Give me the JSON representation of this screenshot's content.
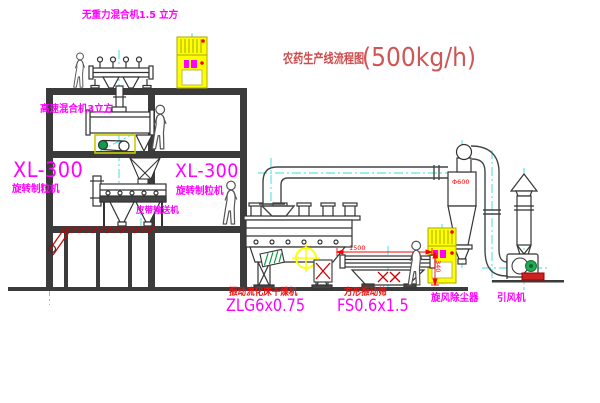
{
  "title": {
    "name": "农药生产线流程图",
    "capacity": "(500kg/h)"
  },
  "equipment_labels": {
    "gravity_mixer": "无重力混合机1.5 立方",
    "high_speed_mixer": "高速混合机3立方",
    "granulator_left_model": "XL-300",
    "granulator_left_name": "旋转制粒机",
    "granulator_right_model": "XL-300",
    "granulator_right_name": "旋转制粒机",
    "belt_conveyor": "皮带输送机",
    "dryer_name": "振动流化床干燥机",
    "dryer_model": "ZLG6x0.75",
    "screen_name": "方形振动筛",
    "screen_model": "FS0.6x1.5",
    "cyclone": "旋风除尘器",
    "induced_draft_fan": "引风机"
  },
  "dimensions": {
    "screen_length": "1500",
    "screen_height": "340",
    "cyclone_diameter": "Φ600"
  },
  "colors": {
    "magenta_label": "#ff00ff",
    "red_label": "#ee1111",
    "title_red": "#cf4a4a",
    "dimension_red": "#ff0000",
    "cabinet_yellow": "#ffff00",
    "centerline_cyan": "#3fd8d8",
    "structure_gray": "#3b3b3b",
    "line_dark": "#333333",
    "motor_green": "#119944"
  }
}
